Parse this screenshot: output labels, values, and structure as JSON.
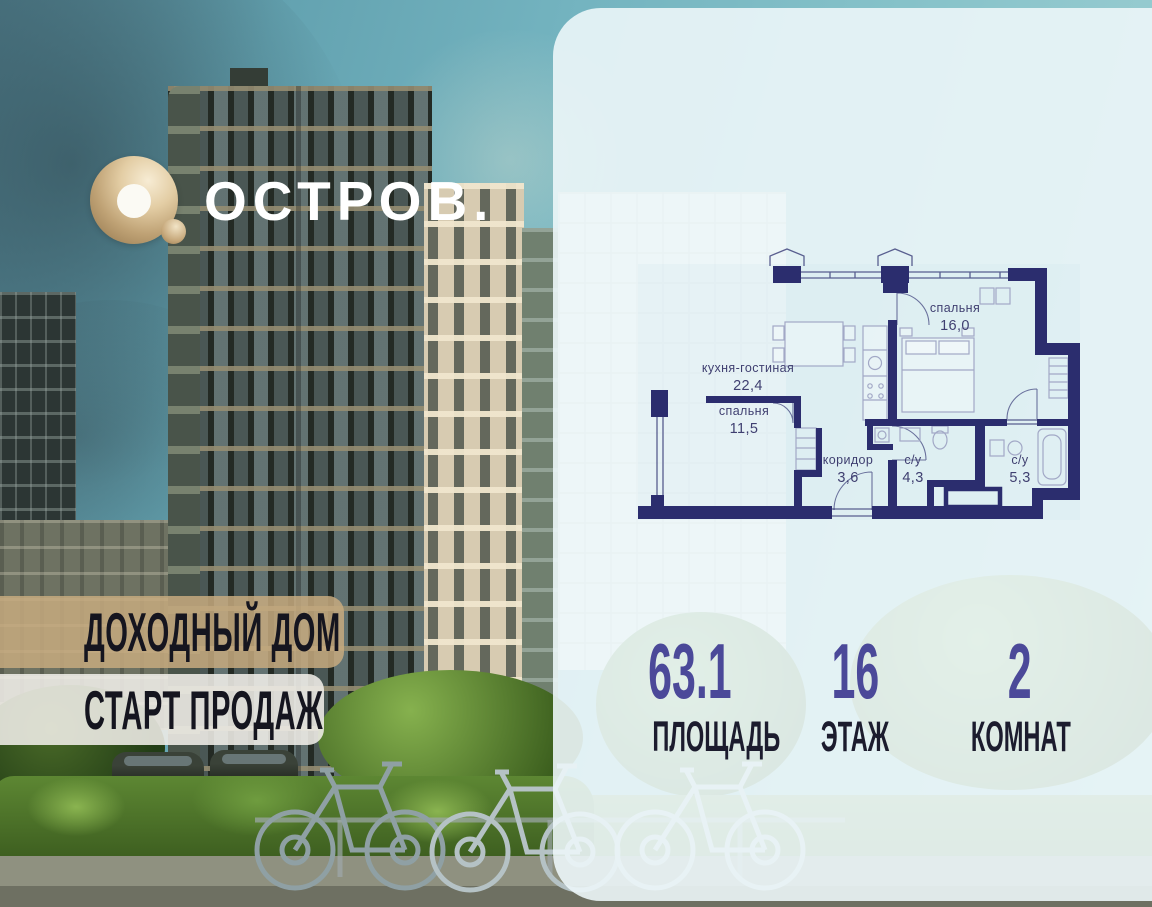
{
  "logo": {
    "o_icon": "ostrov-ring-logo",
    "text": "ОСТРОВ."
  },
  "banners": [
    {
      "label": "ДОХОДНЫЙ ДОМ"
    },
    {
      "label": "СТАРТ ПРОДАЖ"
    }
  ],
  "plan": {
    "rooms": [
      {
        "name": "кухня-гостиная",
        "area": "22,4"
      },
      {
        "name": "спальня",
        "area": "16,0"
      },
      {
        "name": "спальня",
        "area": "11,5"
      },
      {
        "name": "коридор",
        "area": "3,6"
      },
      {
        "name": "с/у",
        "area": "4,3"
      },
      {
        "name": "с/у",
        "area": "5,3"
      }
    ]
  },
  "stats": [
    {
      "value": "63.1",
      "label": "ПЛОЩАДЬ"
    },
    {
      "value": "16",
      "label": "ЭТАЖ"
    },
    {
      "value": "2",
      "label": "КОМНАТ"
    }
  ],
  "colors": {
    "plan_wall_navy": "#2b2d6e",
    "stat_accent_purple": "#4b4999",
    "banner_tan": "rgba(199,170,127,0.85)",
    "banner_cream": "rgba(240,238,232,0.88)",
    "panel_wash": "rgba(236,246,248,0.9)",
    "logo_gold": "#cbb083"
  }
}
